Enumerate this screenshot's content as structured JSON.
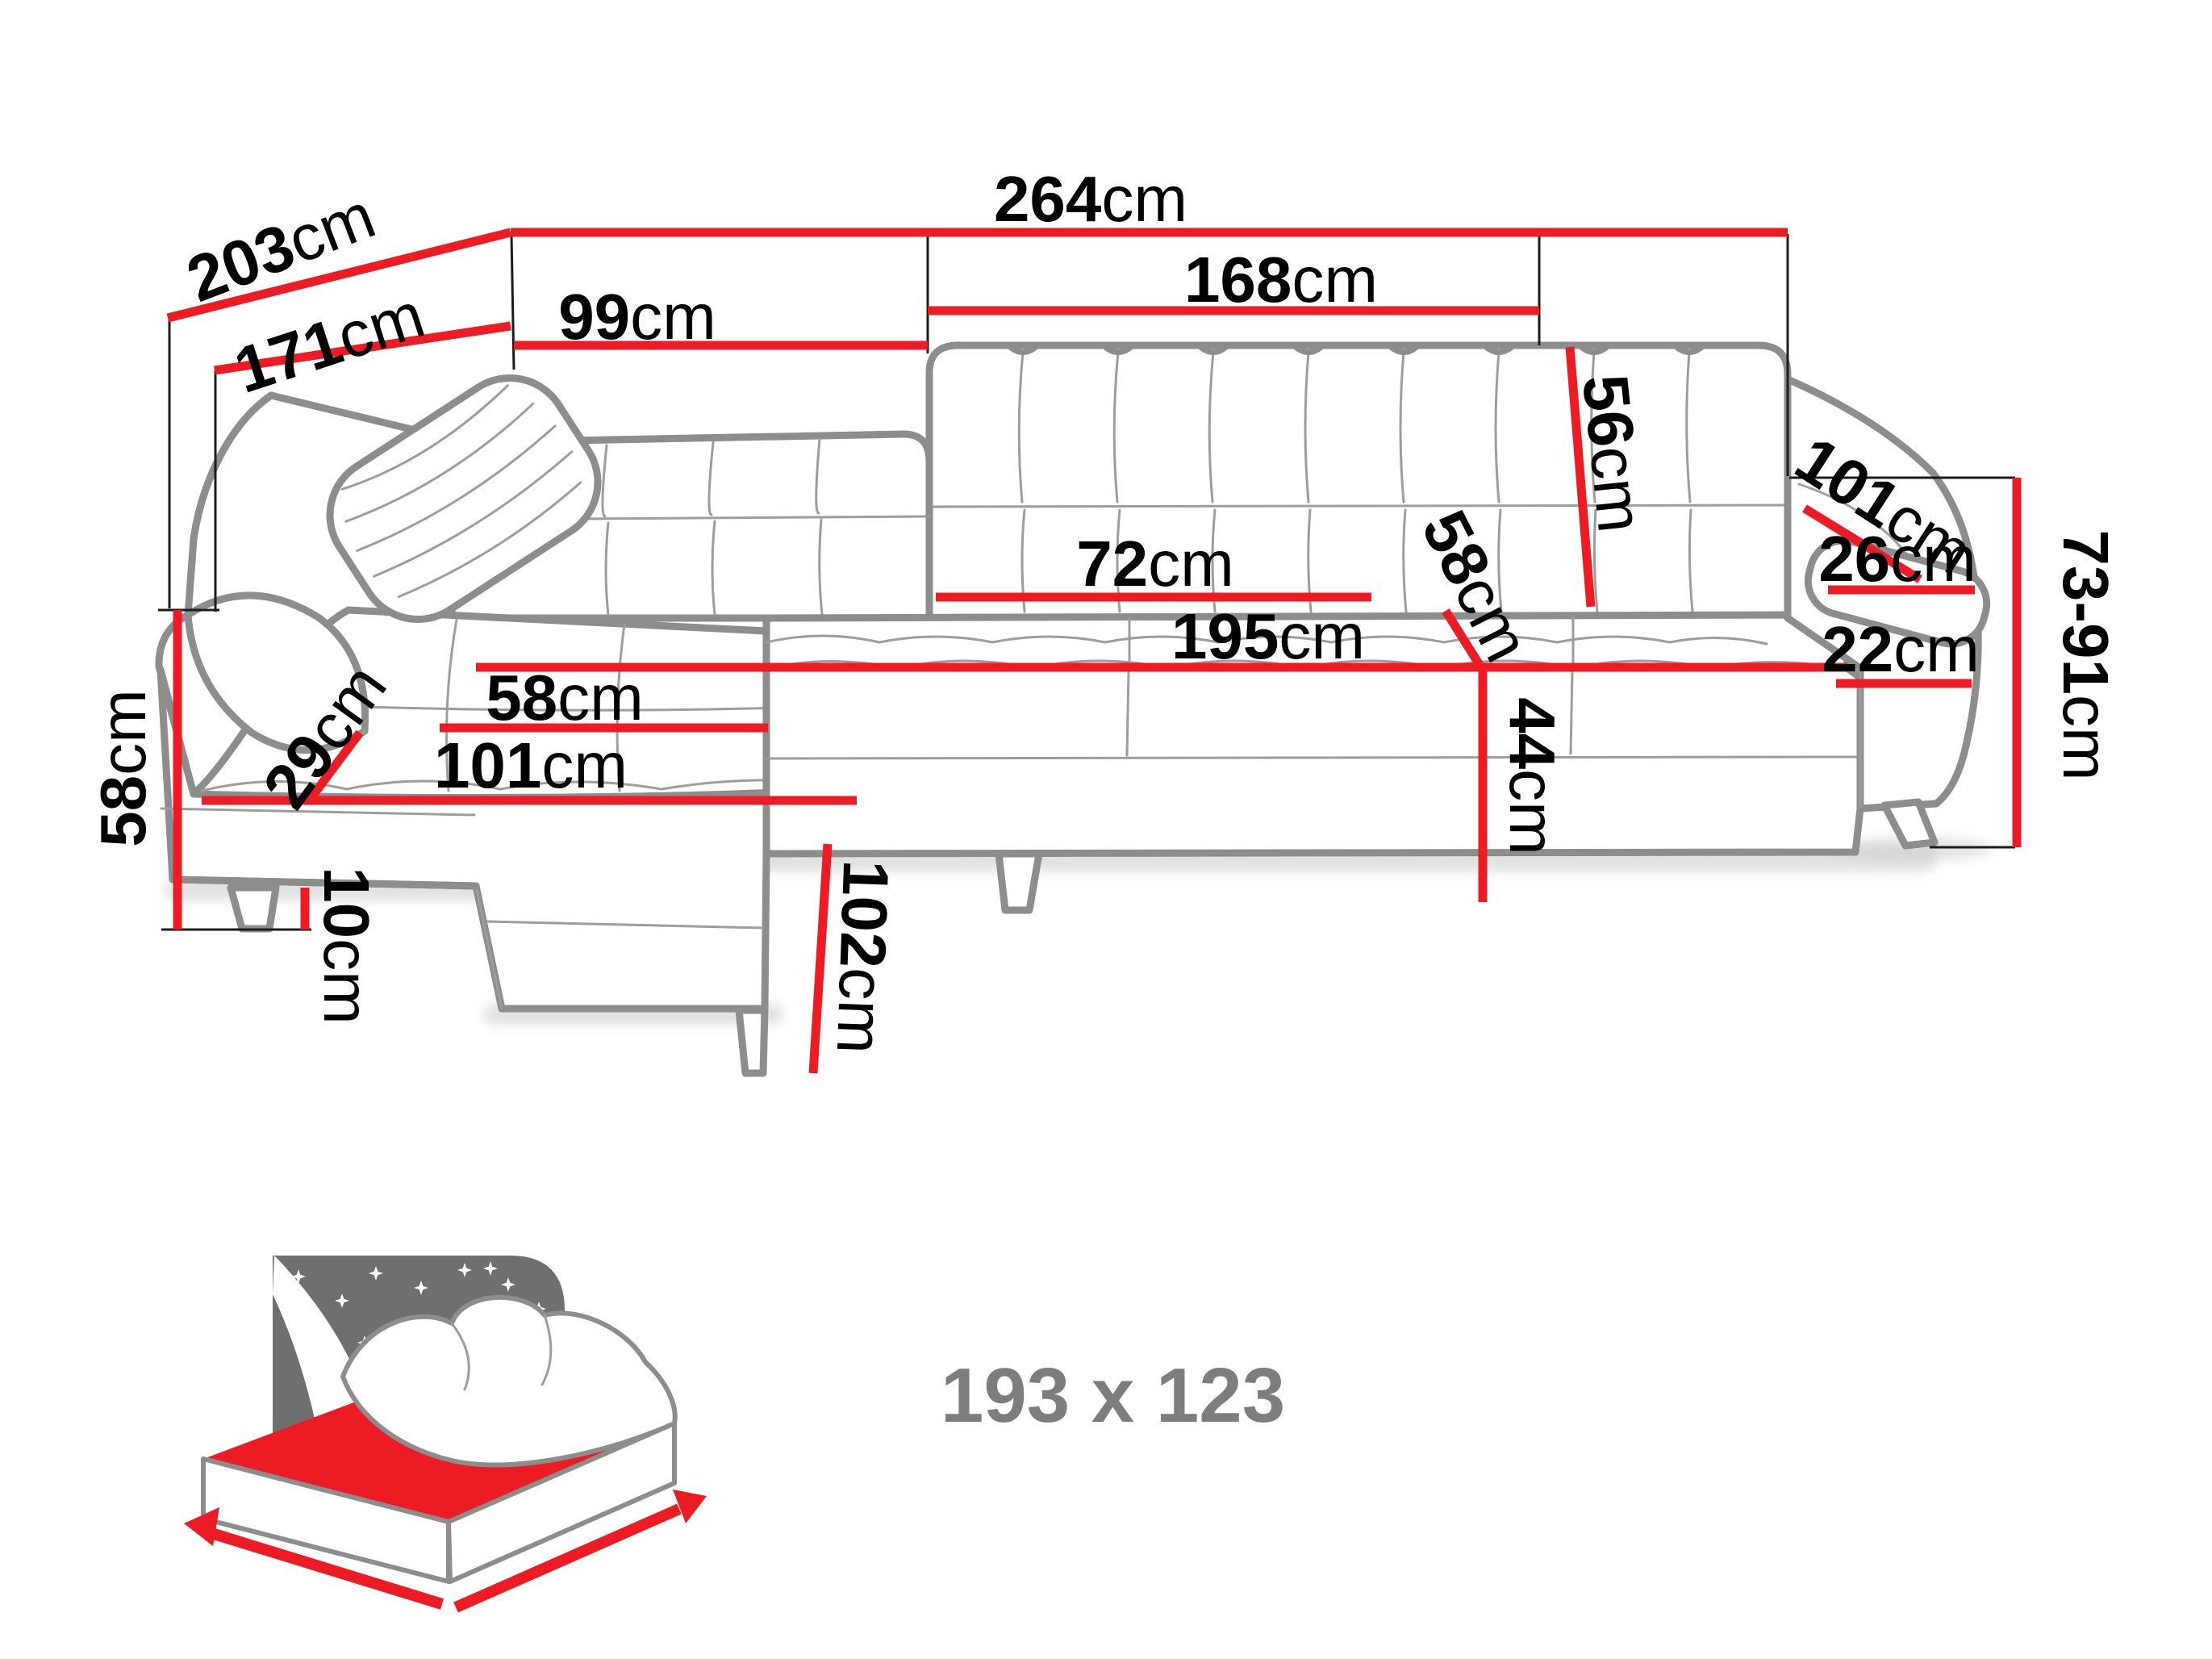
{
  "diagram": {
    "type": "corner-sofa-dimension-drawing",
    "colors": {
      "dimension_line": "#ed1c24",
      "sofa_outline": "#8d8d8d",
      "label_text": "#000000",
      "icon_grey": "#6f6f6f",
      "sleep_text": "#7d7d7d"
    },
    "dimensions": {
      "total_width": {
        "value": "264",
        "unit": "cm"
      },
      "total_depth": {
        "value": "203",
        "unit": "cm"
      },
      "inner_depth": {
        "value": "171",
        "unit": "cm"
      },
      "back_section_left": {
        "value": "99",
        "unit": "cm"
      },
      "back_section_right": {
        "value": "168",
        "unit": "cm"
      },
      "backrest_height": {
        "value": "56",
        "unit": "cm"
      },
      "armrest_top_length": {
        "value": "101",
        "unit": "cm"
      },
      "armrest_pillow_depth": {
        "value": "26",
        "unit": "cm"
      },
      "height_range": {
        "value": "73-91",
        "unit": "cm"
      },
      "armrest_side_depth": {
        "value": "22",
        "unit": "cm"
      },
      "seat_length": {
        "value": "195",
        "unit": "cm"
      },
      "seat_depth_diagonal": {
        "value": "58",
        "unit": "cm"
      },
      "seat_height": {
        "value": "44",
        "unit": "cm"
      },
      "seat_section_width": {
        "value": "72",
        "unit": "cm"
      },
      "chaise_seat_width": {
        "value": "58",
        "unit": "cm"
      },
      "chaise_length": {
        "value": "101",
        "unit": "cm"
      },
      "armrest_front_width": {
        "value": "29",
        "unit": "cm"
      },
      "side_height": {
        "value": "58",
        "unit": "cm"
      },
      "leg_height": {
        "value": "10",
        "unit": "cm"
      },
      "chaise_front_length": {
        "value": "102",
        "unit": "cm"
      }
    },
    "sleeping_area": {
      "label": "193 x 123"
    }
  }
}
